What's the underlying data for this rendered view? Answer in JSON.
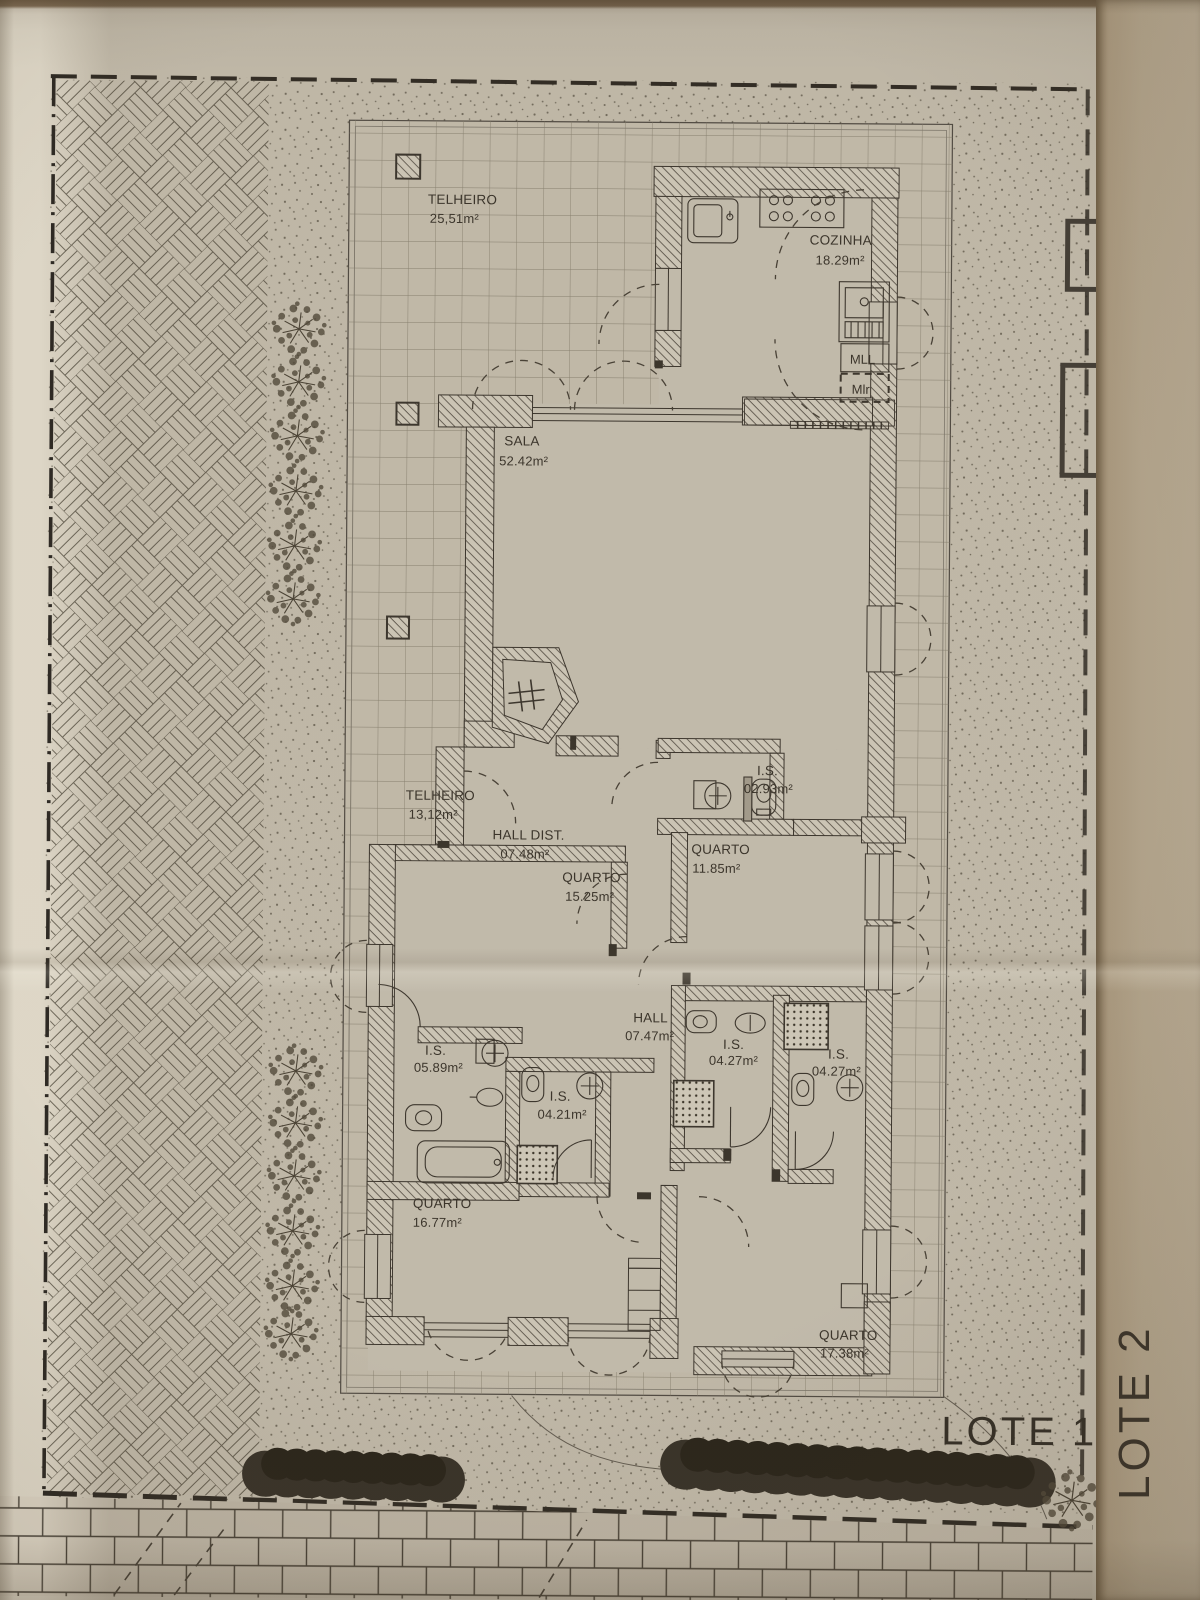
{
  "plan": {
    "lot_label": "LOTE 1",
    "adjacent_lot_label": "LOTE 2",
    "rooms": [
      {
        "name": "TELHEIRO",
        "area": "25,51m²"
      },
      {
        "name": "COZINHA",
        "area": "18.29m²"
      },
      {
        "name": "SALA",
        "area": "52.42m²"
      },
      {
        "name": "TELHEIRO",
        "area": "13,12m²"
      },
      {
        "name": "HALL DIST.",
        "area": "07.48m²"
      },
      {
        "name": "I.S.",
        "area": "02.93m²"
      },
      {
        "name": "QUARTO",
        "area": "11.85m²"
      },
      {
        "name": "QUARTO",
        "area": "15.25m²"
      },
      {
        "name": "HALL",
        "area": "07.47m²"
      },
      {
        "name": "I.S.",
        "area": "05.89m²"
      },
      {
        "name": "I.S.",
        "area": "04.21m²"
      },
      {
        "name": "I.S.",
        "area": "04.27m²"
      },
      {
        "name": "I.S.",
        "area": "04.27m²"
      },
      {
        "name": "QUARTO",
        "area": "16.77m²"
      },
      {
        "name": "QUARTO",
        "area": "17.38m²"
      }
    ],
    "appliance_labels": {
      "dishwasher": "MLL",
      "washing_machine": "Mlr"
    },
    "colors": {
      "paper": "#ddd6c6",
      "ink": "#3b362f",
      "margin_tan": "#c6b69b"
    }
  }
}
